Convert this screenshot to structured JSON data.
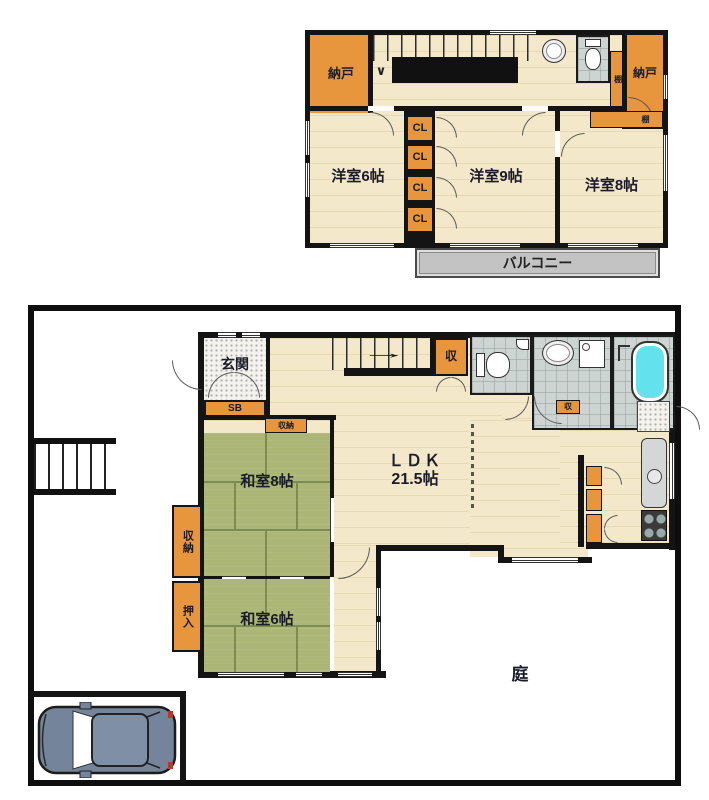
{
  "floor2": {
    "nando_left": "納戸",
    "nando_right": "納戸",
    "shelf_vertical": "棚",
    "shelf_room8": "棚",
    "closets": [
      "CL",
      "CL",
      "CL",
      "CL"
    ],
    "room_west": "洋室6帖",
    "room_center": "洋室9帖",
    "room_east": "洋室8帖",
    "balcony": "バルコニー",
    "stairs_down_arrow": "∨"
  },
  "floor1": {
    "entrance": "玄関",
    "shoe_box": "SB",
    "hall_closet": "収納",
    "stair_closet": "収",
    "washroom_closet": "収",
    "ldk_line1": "ＬＤＫ",
    "ldk_line2": "21.5帖",
    "japanese_room_8": "和室8帖",
    "japanese_room_6": "和室6帖",
    "closet_west": "収納",
    "oshiire": "押入",
    "garden": "庭",
    "stairs_up_arrow": "→"
  },
  "colors": {
    "wall": "#141414",
    "floor_cream": "#F3E8C9",
    "closet_orange": "#E8963E",
    "tatami_green": "#ABB677",
    "tile_gray": "#CDD4D2",
    "balcony_gray": "#C3C3C3",
    "bathtub_cyan": "#63E1EC",
    "label_text": "#1B1B2A"
  }
}
